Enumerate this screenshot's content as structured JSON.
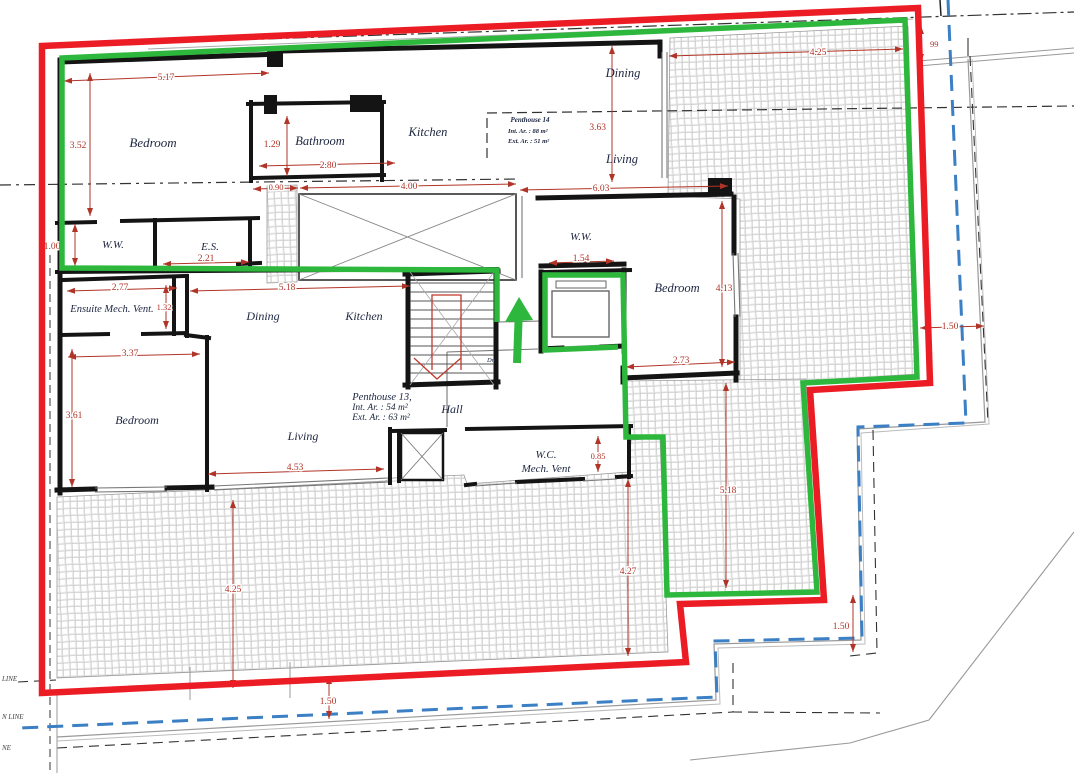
{
  "page": {
    "width": 1074,
    "height": 773,
    "background": "#ffffff"
  },
  "colors": {
    "boundary_red": "#ec1c24",
    "boundary_green": "#2db83d",
    "site_blue": "#3b7fc4",
    "dimension_red": "#b03427",
    "wall_black": "#141414",
    "label_navy": "#1c2540",
    "hatch_gray": "#b5b5b5",
    "line_gray": "#999999"
  },
  "units": {
    "penthouse14": {
      "title": "Penthouse 14",
      "int_area": "Int. Ar. : 88 m²",
      "ext_area": "Ext. Ar. : 51 m²"
    },
    "penthouse13": {
      "title": "Penthouse 13,",
      "int_area": "Int. Ar. : 54 m²",
      "ext_area": "Ext. Ar. : 63 m²"
    }
  },
  "rooms": {
    "ph14_bedroom": "Bedroom",
    "ph14_bathroom": "Bathroom",
    "ph14_kitchen": "Kitchen",
    "ph14_dining": "Dining",
    "ph14_living": "Living",
    "ph14_ww_left": "W.W.",
    "ph14_es": "E.S.",
    "ph14_ww_right": "W.W.",
    "ph14_bedroom_right": "Bedroom",
    "ph13_ensuite": "Ensuite Mech. Vent.",
    "ph13_dining": "Dining",
    "ph13_kitchen": "Kitchen",
    "ph13_bedroom": "Bedroom",
    "ph13_living": "Living",
    "ph13_hall": "Hall",
    "ph13_wc": "W.C.",
    "ph13_mech_vent": "Mech. Vent",
    "stair_down": "Dn"
  },
  "dimensions": {
    "ph14_bedroom_w": "5.17",
    "ph14_bedroom_h": "3.52",
    "ph14_bathroom_h": "1.29",
    "ph14_bathroom_w": "2.80",
    "ph14_shaft_w": "0.90",
    "ph14_void_w": "4.00",
    "ph14_living_w": "6.03",
    "ph14_dining_h": "3.63",
    "terrace_top_w": "4.25",
    "terrace_top_e": "99",
    "ph14_ww_h": "1.00",
    "ph14_es_w": "2.21",
    "ph14_ww_right_w": "1.54",
    "ph14_bedroom_right_h": "4.13",
    "ph14_bedroom_right_w": "2.73",
    "ph13_ensuite_w": "2.77",
    "ph13_ensuite_h": "1.32",
    "ph13_kitchen_w": "5.18",
    "ph13_bedroom_w": "3.37",
    "ph13_bedroom_h": "3.61",
    "ph13_living_w": "4.53",
    "ph13_wc_h": "0.85",
    "terrace_left_h": "4.25",
    "terrace_mid_h": "4.27",
    "terrace_right_h": "5.18",
    "site_offset_right": "1.50",
    "site_offset_bottom_right": "1.50",
    "site_offset_bottom": "1.50"
  },
  "site_labels": {
    "label_1": "LINE",
    "label_2": "N LINE",
    "label_3": "NE"
  }
}
